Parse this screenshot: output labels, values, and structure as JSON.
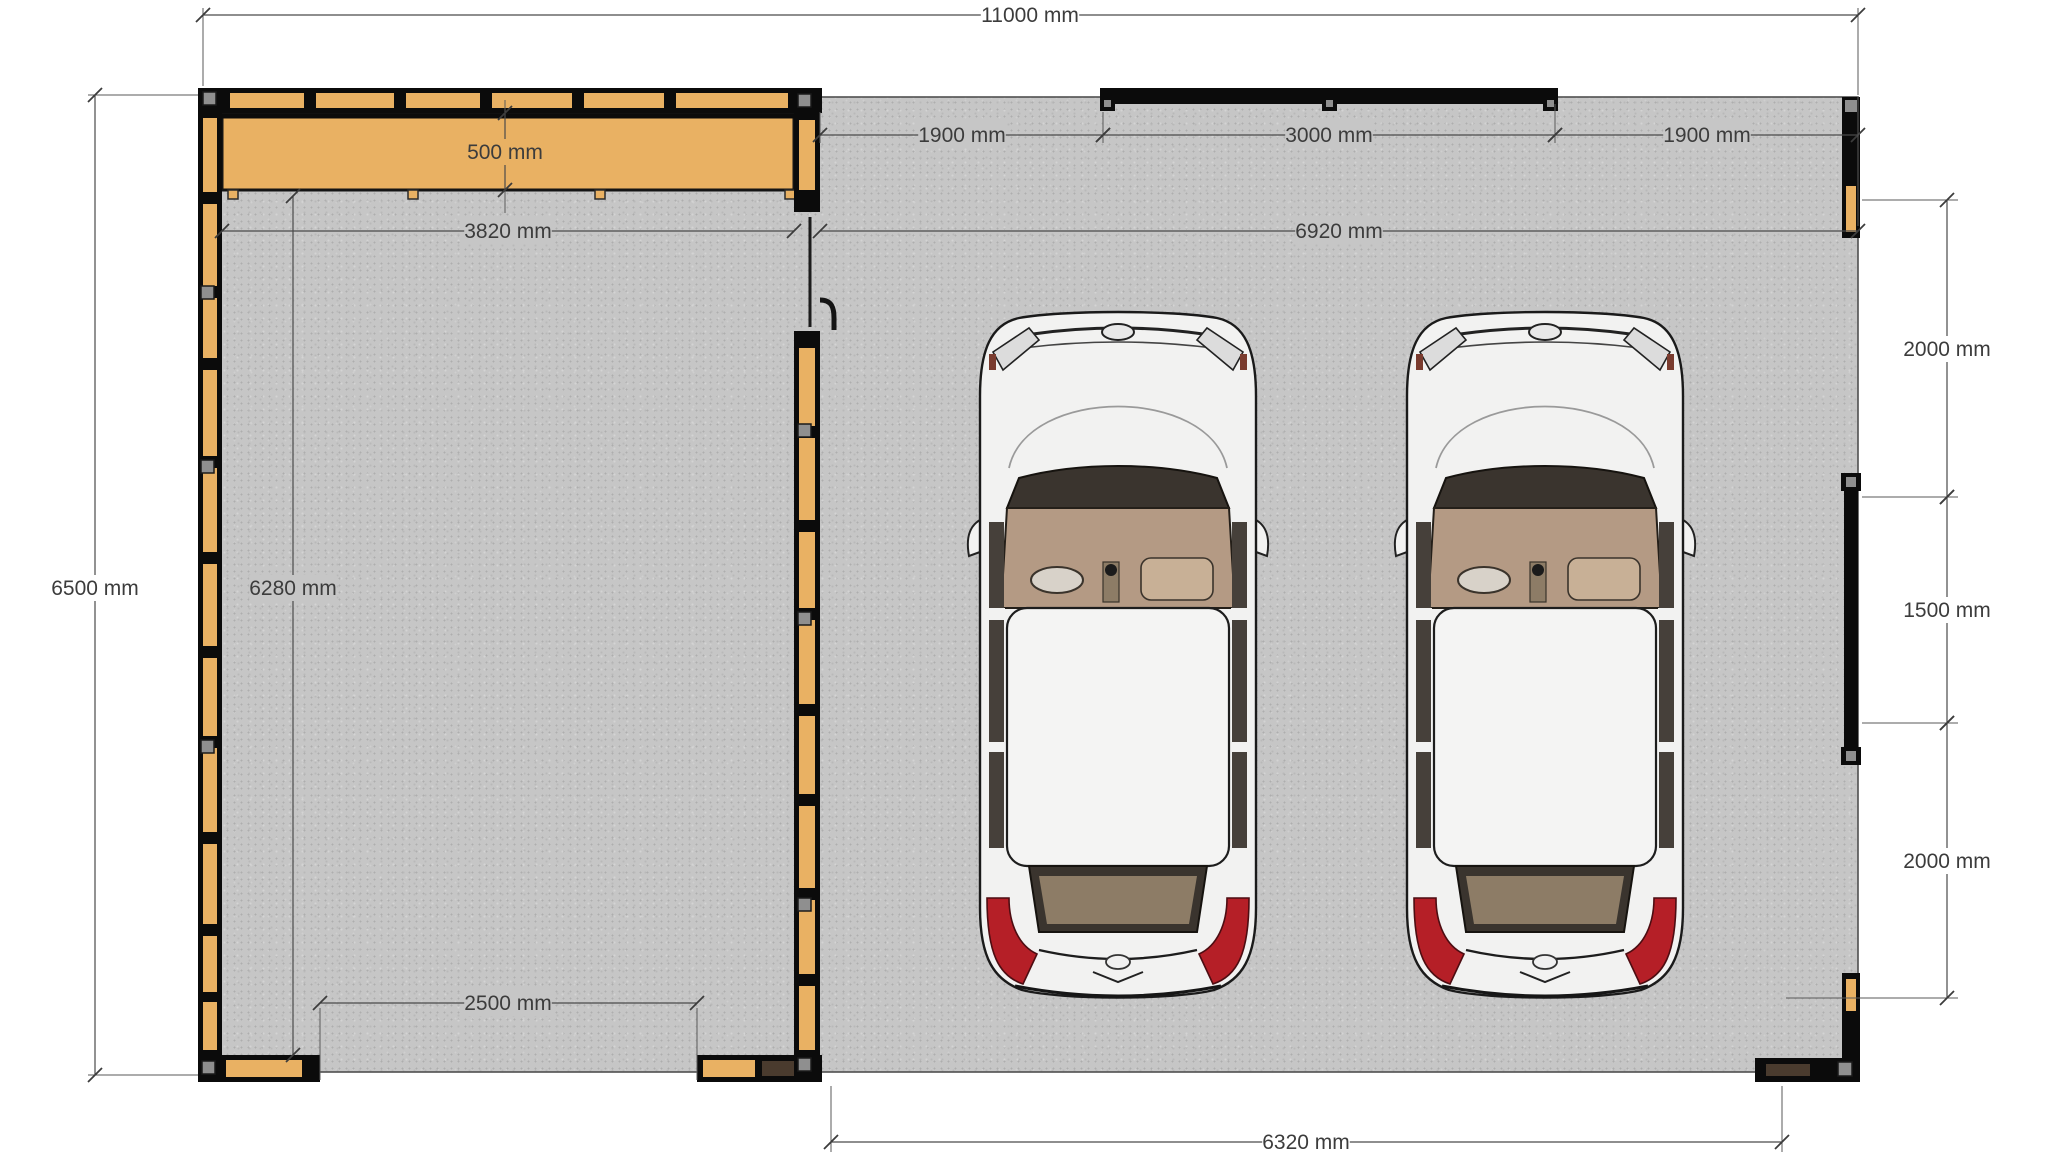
{
  "canvas": {
    "width": 2058,
    "height": 1158,
    "background": "#ffffff"
  },
  "colors": {
    "slab": "#c6c6c6",
    "slab_edge": "#4f4f4f",
    "frame": "#0b0b0b",
    "wood": "#e9b163",
    "dark_wood": "#4a3b2e",
    "gray_block": "#8f8f8f",
    "dim_line": "#4a4a4a",
    "dim_text": "#3c3c3c",
    "car_body": "#f2f2f1",
    "car_cabin": "#b49a84",
    "car_shelf": "#8d7c66",
    "car_glass": "#3a342e",
    "tail_light": "#b51f27"
  },
  "slab": {
    "x": 200,
    "y": 97,
    "w": 1658,
    "h": 975
  },
  "beam": {
    "x": 222,
    "y": 113,
    "w": 572,
    "h": 77,
    "tabs": [
      228,
      408,
      595,
      785
    ]
  },
  "walls": [
    {
      "id": "garage-left-wall",
      "dir": "v",
      "x": 198,
      "y": 88,
      "w": 24,
      "h": 994,
      "wood": [
        [
          118,
          74
        ],
        [
          204,
          82
        ],
        [
          298,
          60
        ],
        [
          370,
          86
        ],
        [
          468,
          84
        ],
        [
          564,
          82
        ],
        [
          658,
          78
        ],
        [
          748,
          84
        ],
        [
          844,
          80
        ],
        [
          936,
          56
        ],
        [
          1002,
          48
        ]
      ],
      "gray": [
        [
          201,
          92
        ],
        [
          201,
          286
        ],
        [
          201,
          460
        ],
        [
          201,
          740
        ]
      ],
      "dark": []
    },
    {
      "id": "garage-top-wall",
      "dir": "h",
      "x": 198,
      "y": 88,
      "w": 624,
      "h": 25,
      "wood": [
        [
          230,
          74
        ],
        [
          316,
          78
        ],
        [
          406,
          74
        ],
        [
          492,
          80
        ],
        [
          584,
          80
        ],
        [
          676,
          112
        ]
      ],
      "gray": [
        [
          203,
          92
        ]
      ],
      "dark": []
    },
    {
      "id": "garage-bottom-wall-left",
      "dir": "h",
      "x": 198,
      "y": 1055,
      "w": 122,
      "h": 27,
      "wood": [
        [
          226,
          76
        ]
      ],
      "gray": [
        [
          202,
          1061
        ]
      ],
      "dark": []
    },
    {
      "id": "garage-bottom-wall-right",
      "dir": "h",
      "x": 697,
      "y": 1055,
      "w": 125,
      "h": 27,
      "wood": [
        [
          703,
          52
        ]
      ],
      "gray": [],
      "dark": [
        [
          762,
          34
        ]
      ]
    },
    {
      "id": "middle-wall-upper",
      "dir": "v",
      "x": 794,
      "y": 88,
      "w": 26,
      "h": 124,
      "wood": [
        [
          120,
          70
        ]
      ],
      "gray": [
        [
          798,
          94
        ]
      ],
      "dark": []
    },
    {
      "id": "middle-wall-lower",
      "dir": "v",
      "x": 794,
      "y": 331,
      "w": 26,
      "h": 751,
      "wood": [
        [
          348,
          78
        ],
        [
          438,
          82
        ],
        [
          532,
          76
        ],
        [
          620,
          84
        ],
        [
          716,
          78
        ],
        [
          806,
          82
        ],
        [
          900,
          74
        ],
        [
          986,
          64
        ]
      ],
      "gray": [
        [
          798,
          424
        ],
        [
          798,
          612
        ],
        [
          798,
          898
        ],
        [
          798,
          1058
        ]
      ],
      "dark": []
    }
  ],
  "door": {
    "leaf_x": 810,
    "y1": 217,
    "y2": 327,
    "handle_x": 820,
    "handle_y": 300
  },
  "carport": {
    "beam": {
      "x": 1100,
      "y": 88,
      "w": 458,
      "h": 16
    },
    "beam_posts": [
      1100,
      1322,
      1543
    ],
    "beam_post_size": 15,
    "beam_post_y": 96,
    "right_top_post": {
      "x": 1842,
      "y": 97,
      "w": 18,
      "h": 141,
      "gray": [
        1845,
        100
      ],
      "wood": [
        1846,
        186,
        10,
        46
      ]
    },
    "right_mid_wall": {
      "x": 1844,
      "y": 473,
      "w": 14,
      "h": 292,
      "caps": [
        [
          1841,
          473
        ],
        [
          1841,
          747
        ]
      ],
      "cap_size": 20
    },
    "right_bottom_v": {
      "x": 1842,
      "y": 973,
      "w": 18,
      "h": 109,
      "wood": [
        1846,
        979,
        10,
        32
      ]
    },
    "right_bottom_h": {
      "x": 1755,
      "y": 1058,
      "w": 105,
      "h": 24,
      "dark": [
        1766,
        1064,
        44,
        12
      ],
      "gray": [
        1838,
        1062
      ]
    }
  },
  "cars": {
    "positions": [
      [
        975,
        308
      ],
      [
        1402,
        308
      ]
    ],
    "w": 286,
    "h": 694
  },
  "dimensions": [
    {
      "id": "overall-width",
      "label": "11000 mm",
      "x1": 203,
      "y1": 15,
      "x2": 1858,
      "y2": 15,
      "lx": 1030,
      "ly": 15,
      "bg": "white",
      "ext": [
        [
          203,
          8,
          203,
          86
        ],
        [
          1858,
          8,
          1858,
          95
        ]
      ]
    },
    {
      "id": "carport-bay-left",
      "label": "1900 mm",
      "x1": 820,
      "y1": 135,
      "x2": 1103,
      "y2": 135,
      "lx": 962,
      "ly": 135,
      "bg": "slab",
      "ext": [
        [
          820,
          112,
          820,
          143
        ],
        [
          1103,
          112,
          1103,
          143
        ]
      ]
    },
    {
      "id": "carport-bay-middle",
      "label": "3000 mm",
      "x1": 1103,
      "y1": 135,
      "x2": 1555,
      "y2": 135,
      "lx": 1329,
      "ly": 135,
      "bg": "slab",
      "ext": [
        [
          1555,
          104,
          1555,
          143
        ]
      ]
    },
    {
      "id": "carport-bay-right",
      "label": "1900 mm",
      "x1": 1555,
      "y1": 135,
      "x2": 1858,
      "y2": 135,
      "lx": 1707,
      "ly": 135,
      "bg": "slab",
      "ext": []
    },
    {
      "id": "garage-inner-width",
      "label": "3820 mm",
      "x1": 222,
      "y1": 231,
      "x2": 794,
      "y2": 231,
      "lx": 508,
      "ly": 231,
      "bg": "slab",
      "ext": []
    },
    {
      "id": "carport-width",
      "label": "6920 mm",
      "x1": 820,
      "y1": 231,
      "x2": 1858,
      "y2": 231,
      "lx": 1339,
      "ly": 231,
      "bg": "slab",
      "ext": [
        [
          1858,
          97,
          1858,
          226
        ]
      ]
    },
    {
      "id": "beam-depth",
      "label": "500 mm",
      "x1": 505,
      "y1": 113,
      "x2": 505,
      "y2": 190,
      "lx": 505,
      "ly": 152,
      "bg": "wood",
      "ext": [
        [
          505,
          100,
          505,
          113
        ],
        [
          505,
          190,
          505,
          213
        ]
      ]
    },
    {
      "id": "overall-height",
      "label": "6500 mm",
      "x1": 95,
      "y1": 95,
      "x2": 95,
      "y2": 1075,
      "lx": 95,
      "ly": 588,
      "bg": "white",
      "ext": [
        [
          198,
          95,
          88,
          95
        ],
        [
          198,
          1075,
          88,
          1075
        ]
      ]
    },
    {
      "id": "garage-inner-height",
      "label": "6280 mm",
      "x1": 293,
      "y1": 196,
      "x2": 293,
      "y2": 1055,
      "lx": 293,
      "ly": 588,
      "bg": "slab",
      "ext": []
    },
    {
      "id": "garage-door-width",
      "label": "2500 mm",
      "x1": 320,
      "y1": 1003,
      "x2": 697,
      "y2": 1003,
      "lx": 508,
      "ly": 1003,
      "bg": "slab",
      "ext": [
        [
          320,
          1008,
          320,
          1080
        ],
        [
          697,
          1008,
          697,
          1080
        ]
      ]
    },
    {
      "id": "right-span-top",
      "label": "2000 mm",
      "x1": 1947,
      "y1": 200,
      "x2": 1947,
      "y2": 497,
      "lx": 1947,
      "ly": 349,
      "bg": "white",
      "ext": [
        [
          1862,
          200,
          1958,
          200
        ]
      ]
    },
    {
      "id": "right-span-middle",
      "label": "1500 mm",
      "x1": 1947,
      "y1": 497,
      "x2": 1947,
      "y2": 723,
      "lx": 1947,
      "ly": 610,
      "bg": "white",
      "ext": [
        [
          1862,
          497,
          1958,
          497
        ]
      ]
    },
    {
      "id": "right-span-bottom",
      "label": "2000 mm",
      "x1": 1947,
      "y1": 723,
      "x2": 1947,
      "y2": 998,
      "lx": 1947,
      "ly": 861,
      "bg": "white",
      "ext": [
        [
          1862,
          723,
          1958,
          723
        ],
        [
          1786,
          998,
          1958,
          998
        ]
      ]
    },
    {
      "id": "carport-bottom-width",
      "label": "6320 mm",
      "x1": 831,
      "y1": 1142,
      "x2": 1782,
      "y2": 1142,
      "lx": 1306,
      "ly": 1142,
      "bg": "white",
      "ext": [
        [
          831,
          1086,
          831,
          1152
        ],
        [
          1782,
          1086,
          1782,
          1152
        ]
      ]
    }
  ]
}
